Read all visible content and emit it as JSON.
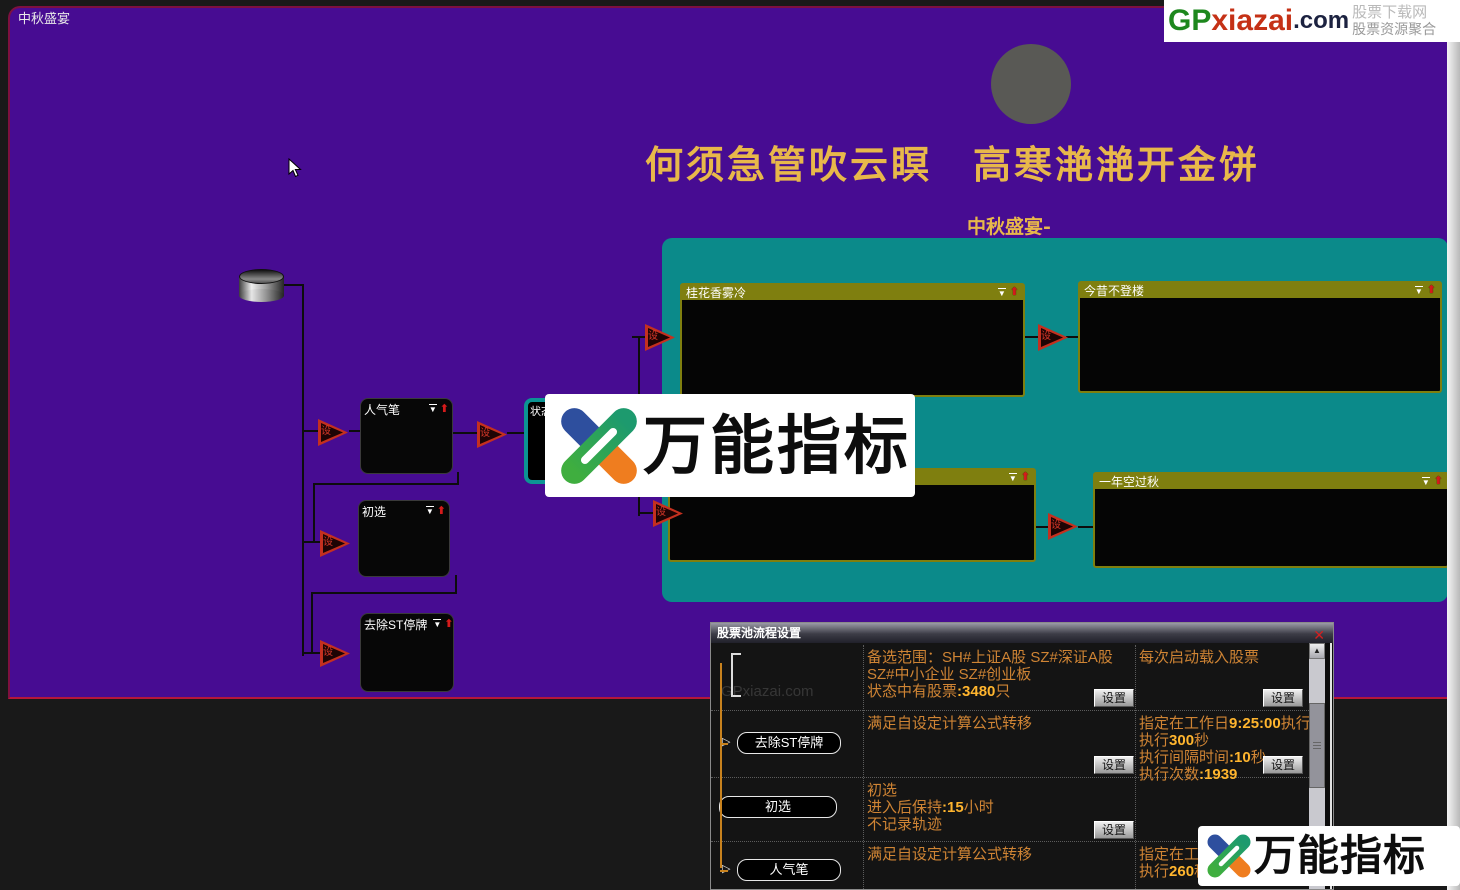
{
  "window": {
    "label": "中秋盛宴"
  },
  "brand_top": {
    "gp": "GP",
    "xiazai": "xiazai",
    "dotcom": ".com",
    "tagline1": "股票下载网",
    "tagline2": "股票资源聚合"
  },
  "poem": {
    "line": "何须急管吹云瞑　高寒滟滟开金饼",
    "subtitle": "中秋盛宴-"
  },
  "flow": {
    "nodes": [
      {
        "label": "人气笔"
      },
      {
        "label": "初选"
      },
      {
        "label": "去除ST停牌"
      }
    ],
    "status_node": {
      "label": "状态"
    },
    "pool_boxes": [
      {
        "title": "桂花香雾冷"
      },
      {
        "title": "今昔不登楼"
      },
      {
        "title": ""
      },
      {
        "title": "一年空过秋"
      }
    ],
    "connector_glyph": "设"
  },
  "icons": {
    "dropdown": "▼",
    "move_up": "⬆",
    "node_arrow": "▷",
    "scroll_up": "▲",
    "close": "✕"
  },
  "dialog": {
    "title": "股票池流程设置",
    "settings_button": "设置",
    "ghost": "GPxiazai.com",
    "rows": [
      {
        "left": null,
        "arrow": false,
        "mid": [
          "备选范围：SH#上证A股 SZ#深证A股",
          "SZ#中小企业 SZ#创业板",
          "状态中有股票:3480只"
        ],
        "right": [
          "每次启动载入股票"
        ],
        "mid_btn": true,
        "right_btn": true
      },
      {
        "left": "去除ST停牌",
        "arrow": true,
        "mid": [
          "满足自设定计算公式转移"
        ],
        "right": [
          "指定在工作日9:25:00执行",
          "执行300秒",
          "执行间隔时间:10秒",
          "执行次数:1939"
        ],
        "mid_btn": true,
        "right_btn": true
      },
      {
        "left": "初选",
        "arrow": false,
        "mid": [
          "初选",
          "进入后保持:15小时",
          "不记录轨迹"
        ],
        "right": [],
        "mid_btn": true,
        "right_btn": false
      },
      {
        "left": "人气笔",
        "arrow": true,
        "mid": [
          "满足自设定计算公式转移"
        ],
        "right": [
          "指定在工作日",
          "执行260秒"
        ],
        "mid_btn": false,
        "right_btn": false
      }
    ]
  },
  "watermark": {
    "text": "万能指标"
  },
  "colors": {
    "purple": "#470c92",
    "teal": "#0b8a8a",
    "olive": "#7f7f0f",
    "gold": "#e8b84a",
    "orange_text": "#cf8434",
    "highlight": "#ffb52e",
    "red_accent": "#cc2222"
  }
}
